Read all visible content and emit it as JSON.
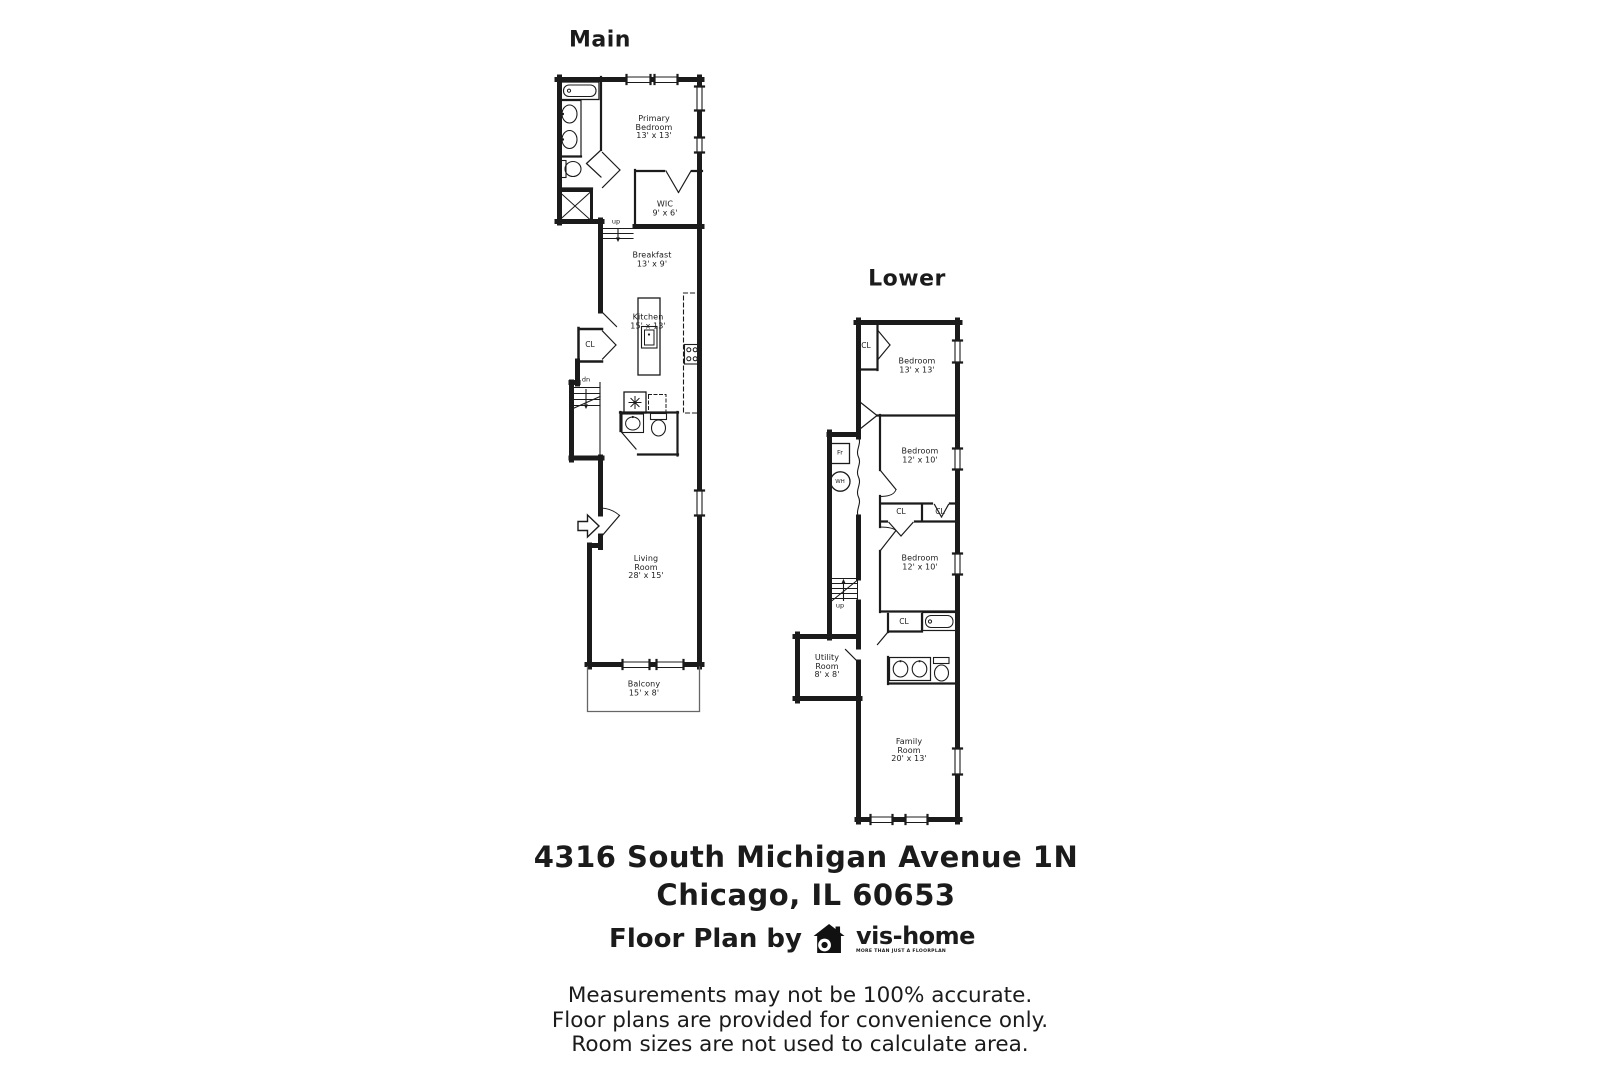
{
  "page": {
    "background_color": "#ffffff",
    "line_color": "#1b1b1b"
  },
  "floors": {
    "main": {
      "title": "Main",
      "rooms": {
        "primary_bedroom": {
          "name": "Primary Bedroom",
          "dims": "13' x 13'"
        },
        "wic": {
          "name": "WIC",
          "dims": "9' x 6'"
        },
        "breakfast": {
          "name": "Breakfast",
          "dims": "13' x 9'"
        },
        "kitchen": {
          "name": "Kitchen",
          "dims": "15' x 13'"
        },
        "living_room": {
          "name": "Living Room",
          "dims": "28' x 15'"
        },
        "balcony": {
          "name": "Balcony",
          "dims": "15' x 8'"
        }
      }
    },
    "lower": {
      "title": "Lower",
      "rooms": {
        "bedroom_top": {
          "name": "Bedroom",
          "dims": "13' x 13'"
        },
        "bedroom_mid": {
          "name": "Bedroom",
          "dims": "12' x 10'"
        },
        "bedroom_bottom": {
          "name": "Bedroom",
          "dims": "12' x 10'"
        },
        "utility_room": {
          "name": "Utility Room",
          "dims": "8' x 8'"
        },
        "family_room": {
          "name": "Family Room",
          "dims": "20' x 13'"
        }
      }
    }
  },
  "labels": {
    "closet": "CL",
    "stairs_up": "up",
    "stairs_down": "dn",
    "furnace": "Fr",
    "water_heater": "WH"
  },
  "footer": {
    "address_line_1": "4316 South Michigan Avenue 1N",
    "address_line_2": "Chicago, IL 60653",
    "credit_prefix": "Floor Plan by",
    "logo": {
      "brand": "vis-home",
      "tagline": "MORE THAN JUST A FLOORPLAN"
    },
    "disclaimer_lines": [
      "Measurements may not be 100% accurate.",
      "Floor plans are provided for convenience only.",
      "Room sizes are not used to calculate area."
    ]
  }
}
